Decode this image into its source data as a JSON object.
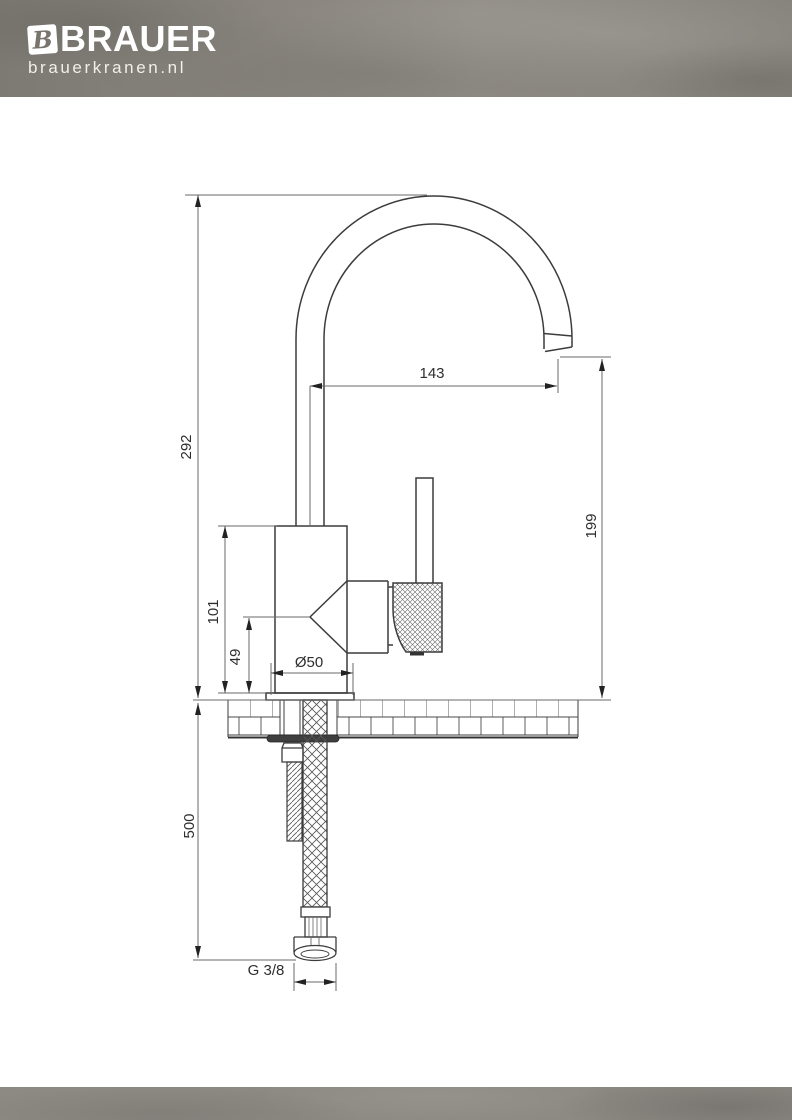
{
  "header": {
    "brand": "BRAUER",
    "site": "brauerkranen.nl",
    "logo_letter": "B"
  },
  "drawing": {
    "type": "faucet technical drawing, side view with mounting cross-section",
    "dimensions": {
      "spout_reach": "143",
      "total_height": "292",
      "outlet_height": "199",
      "body_height": "101",
      "handle_height": "49",
      "base_diameter": "Ø50",
      "hose_length": "500",
      "connection_thread": "G 3/8"
    }
  },
  "colors": {
    "header_bg": "#85817a",
    "footer_bg": "#8d8a84",
    "line": "#3c3c3c",
    "dim_line": "#666666",
    "text": "#2e2e2e",
    "logo_text": "#ffffff"
  }
}
